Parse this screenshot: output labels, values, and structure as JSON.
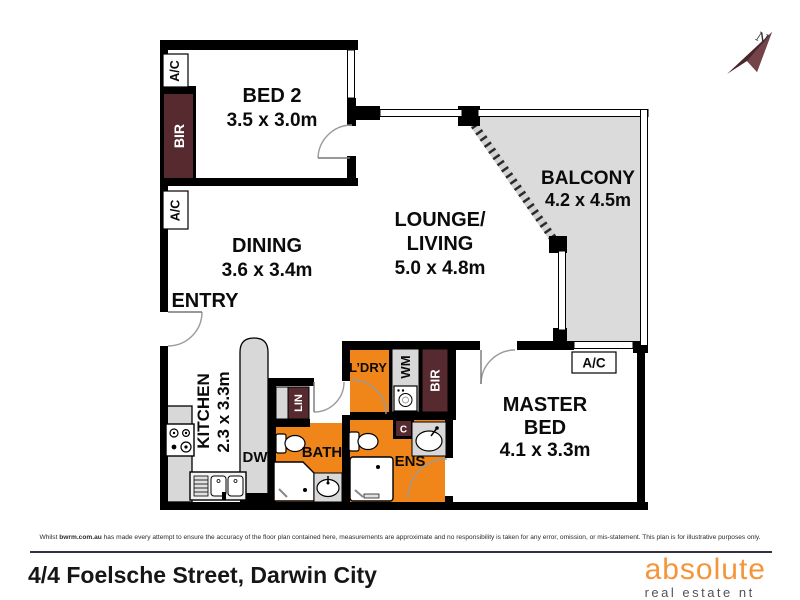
{
  "compass": {
    "north": "N"
  },
  "rooms": {
    "bed2": {
      "name": "BED 2",
      "dims": "3.5 x 3.0m"
    },
    "dining": {
      "name": "DINING",
      "dims": "3.6 x 3.4m"
    },
    "lounge": {
      "name1": "LOUNGE/",
      "name2": "LIVING",
      "dims": "5.0 x 4.8m"
    },
    "balcony": {
      "name": "BALCONY",
      "dims": "4.2 x 4.5m"
    },
    "kitchen": {
      "name": "KITCHEN",
      "dims": "2.3 x 3.3m"
    },
    "master": {
      "name1": "MASTER",
      "name2": "BED",
      "dims": "4.1 x 3.3m"
    },
    "entry": {
      "name": "ENTRY"
    },
    "bath": {
      "name": "BATH"
    },
    "ens": {
      "name": "ENS"
    },
    "ldry": {
      "name": "L’DRY"
    }
  },
  "labels": {
    "ac": "A/C",
    "bir": "BIR",
    "lin": "LIN",
    "wm": "WM",
    "dw": "DW",
    "c": "C"
  },
  "footer": {
    "disclaimer_pre": "Whilst ",
    "disclaimer_bold": "bwrm.com.au",
    "disclaimer_post": " has made every attempt to ensure the accuracy of the floor plan contained here, measurements are approximate and no responsibility is taken for any error, omission, or mis-statement. This plan is for illustrative purposes only.",
    "address": "4/4 Foelsche Street, Darwin City",
    "logo_primary": "absolute",
    "logo_secondary": "real estate nt"
  },
  "colors": {
    "wall": "#000000",
    "wet_area_orange": "#f08519",
    "closet_maroon": "#572a30",
    "balcony_gray": "#dbdbdb",
    "counter_gray": "#d8d8d8",
    "logo_orange": "#f5953a",
    "logo_gray": "#53535b",
    "footer_line": "#32323e"
  }
}
